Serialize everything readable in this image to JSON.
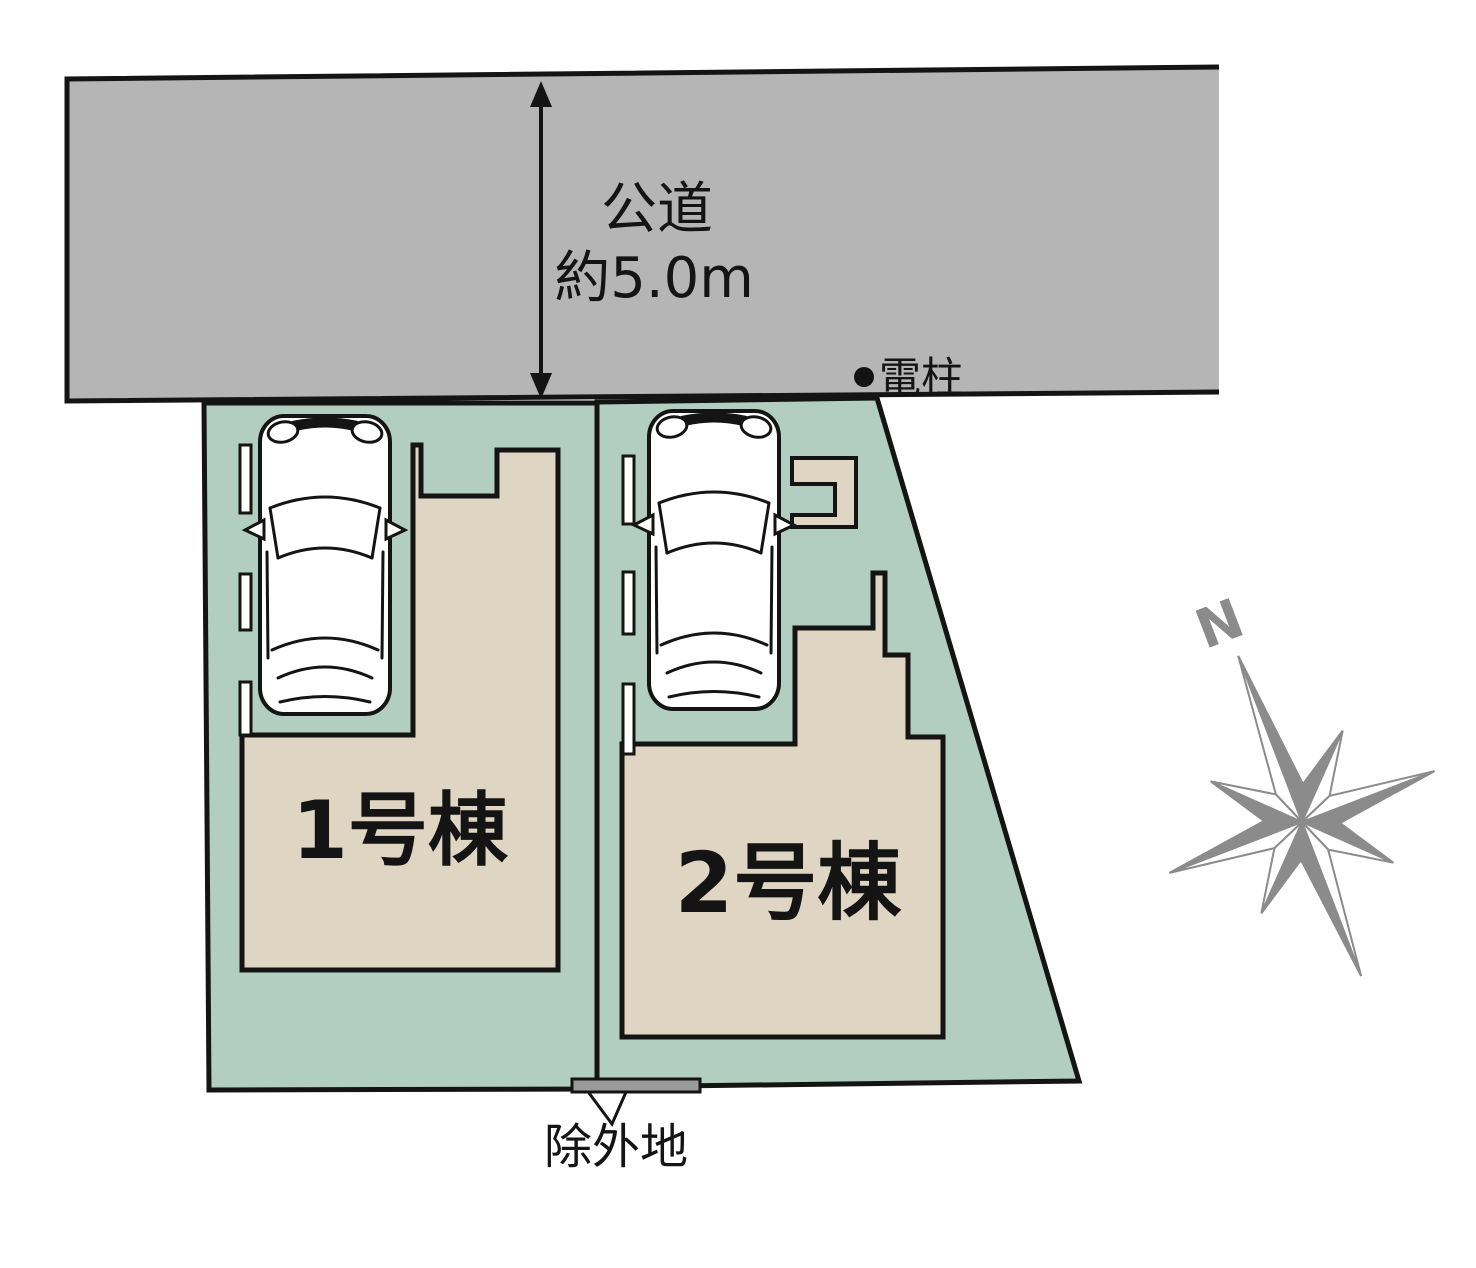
{
  "road": {
    "name_label": "公道",
    "width_label": "約5.0m",
    "utility_pole_label": "電柱"
  },
  "lots": {
    "lot1": {
      "building_label": "1号棟"
    },
    "lot2": {
      "building_label": "2号棟"
    }
  },
  "excluded_area": {
    "label": "除外地"
  },
  "compass": {
    "north_label": "N"
  },
  "colors": {
    "road_fill": "#b5b5b5",
    "lot_fill": "#b2cec0",
    "building_fill": "#ded6c2",
    "parking_mark_fill": "#ffffff",
    "excluded_fill": "#9a9a9a",
    "car_fill": "#ffffff",
    "compass_gray": "#8b8b8b",
    "line": "#141414"
  }
}
